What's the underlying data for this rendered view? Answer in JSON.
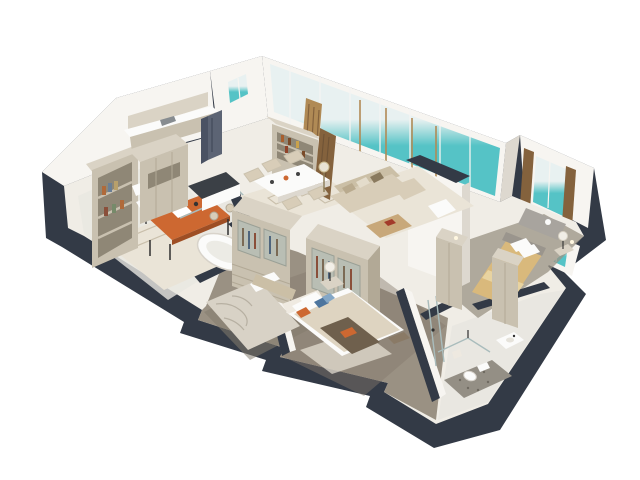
{
  "scene": {
    "type": "3d-floor-plan-render",
    "style": "Isometric cutaway 3D floor plan of a furnished apartment with sea view",
    "background": "#ffffff",
    "projection": "three-quarter isometric, roof removed, section-cut dark wall tops"
  },
  "palette": {
    "background": "#ffffff",
    "wall_dark": "#333a46",
    "wall_darker": "#272d38",
    "wall_white": "#f7f5f1",
    "wall_shade": "#ddd8cf",
    "floor_light": "#f0ede6",
    "carpet": "#9a9183",
    "carpet_dark": "#847b6d",
    "tile": "#e9e7e1",
    "tile_dark": "#948f85",
    "wood": "#c9c1b0",
    "wood_dark": "#b2a996",
    "wood_light": "#dad3c5",
    "wood_recess": "#8f8776",
    "sky": "#e8f1f1",
    "sea": "#55c3c6",
    "sea_light": "#9fdadb",
    "sand": "#e9dcae",
    "curtain": "#b08a55",
    "curtain_dark": "#84623d",
    "sofa": "#d8cdb8",
    "sofa_dark": "#cbbfa6",
    "orange": "#cd6831",
    "orange_dark": "#9e4e24",
    "blue": "#4d759e",
    "blue_light": "#84a7c6",
    "gold": "#d9b97c",
    "gold_light": "#e8d3a0",
    "fixture": "#fbfbfa",
    "cushion": "#a8a49e",
    "rug": "#eae4d7",
    "rug_line": "#c9bfab",
    "glass_line": "#a9bcbc",
    "metal": "#2f2f2f"
  },
  "rooms": {
    "office": {
      "name": "Home office",
      "furniture": [
        "bookshelf",
        "orange desk",
        "white chair",
        "rug"
      ]
    },
    "bathroom": {
      "name": "Bathroom with freestanding tub",
      "furniture": [
        "freestanding bathtub",
        "glass partition"
      ]
    },
    "kitchen": {
      "name": "Kitchen",
      "furniture": [
        "tall cabinets",
        "counter with sink",
        "refrigerator",
        "island with stools",
        "window"
      ]
    },
    "dining": {
      "name": "Dining area",
      "furniture": [
        "dining table",
        "wicker chairs",
        "patterned rug",
        "display shelf with bottles",
        "curtain"
      ]
    },
    "living": {
      "name": "Living room",
      "furniture": [
        "beige sofa",
        "ottoman coffee table",
        "armchair",
        "rug",
        "floor lamp",
        "curtain",
        "floor-to-ceiling sea-view glazing"
      ]
    },
    "hall": {
      "name": "Dressing hall",
      "furniture": [
        "glass-door wardrobe",
        "glass-door wardrobe",
        "pouf"
      ]
    },
    "bedroom_1": {
      "name": "Bedroom (unmade bed)",
      "furniture": [
        "bed with crumpled duvet",
        "pillows"
      ]
    },
    "bedroom_2": {
      "name": "Bedroom with accent pillows",
      "furniture": [
        "bed",
        "orange and blue pillows",
        "nightstand",
        "table lamp",
        "bench",
        "rug"
      ]
    },
    "master_bedroom": {
      "name": "Master bedroom",
      "furniture": [
        "gold bed",
        "two wardrobe towers",
        "window seat",
        "curtains",
        "table lamp",
        "nightstand"
      ]
    },
    "ensuite": {
      "name": "En-suite shower room",
      "furniture": [
        "walk-in shower",
        "toilet",
        "vanity sink",
        "towel"
      ]
    },
    "corridor": {
      "name": "Corridor",
      "furniture": [
        "glass door"
      ]
    }
  },
  "windows": {
    "view": "turquoise sea with sand",
    "glazing_frames": "white mullions with brass posts"
  }
}
